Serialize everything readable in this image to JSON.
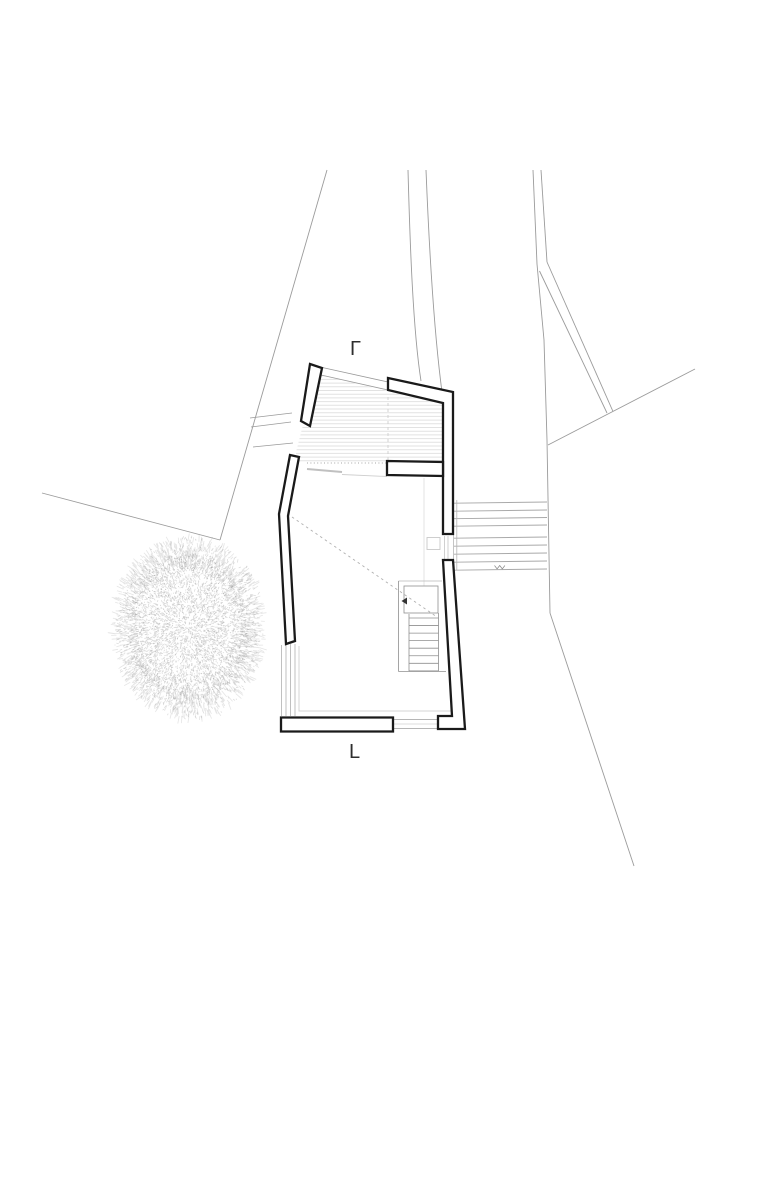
{
  "plan": {
    "title": "site-floor-plan",
    "width": 780,
    "height": 1188,
    "colors": {
      "background": "#ffffff",
      "wall_stroke": "#1a1a1a",
      "wall_fill": "#ffffff",
      "site_line": "#9b9b9b",
      "thin_line": "#8f8f8f",
      "light_line": "#bdbdbd",
      "faint_line": "#e0e0e0",
      "hatch_line": "#e2e2e2",
      "dash_line": "#b0b0b0",
      "tree_stipple": "#7d7d7d",
      "label": "#2e2e2e"
    },
    "labels": [
      {
        "text": "Γ",
        "x": 350,
        "y": 339,
        "size": 20
      },
      {
        "text": "L",
        "x": 349,
        "y": 742,
        "size": 20
      }
    ],
    "walls": [
      [
        [
          310,
          364
        ],
        [
          322,
          368
        ],
        [
          310,
          426
        ],
        [
          301,
          421
        ]
      ],
      [
        [
          388,
          378
        ],
        [
          453,
          392
        ],
        [
          453,
          534
        ],
        [
          443,
          534
        ],
        [
          443,
          403
        ],
        [
          388,
          390
        ]
      ],
      [
        [
          387,
          461
        ],
        [
          443,
          462
        ],
        [
          443,
          476
        ],
        [
          387,
          475
        ]
      ],
      [
        [
          443,
          560
        ],
        [
          453,
          560
        ],
        [
          465,
          729
        ],
        [
          438,
          729
        ],
        [
          438,
          716
        ],
        [
          452,
          716
        ]
      ],
      [
        [
          281,
          717.5
        ],
        [
          393,
          717.5
        ],
        [
          393,
          731.5
        ],
        [
          281,
          731.5
        ]
      ],
      [
        [
          290,
          455
        ],
        [
          299,
          457
        ],
        [
          288,
          516
        ],
        [
          295,
          641
        ],
        [
          286,
          644
        ],
        [
          279,
          514
        ]
      ]
    ],
    "wall_stroke_width": 2.3,
    "site_lines": [
      [
        [
          327,
          170
        ],
        [
          220,
          540
        ]
      ],
      [
        [
          220,
          540
        ],
        [
          42,
          493
        ]
      ],
      [
        [
          533,
          170
        ],
        [
          537,
          264
        ]
      ],
      [
        [
          541,
          170
        ],
        [
          547,
          262
        ]
      ],
      [
        [
          537,
          264
        ],
        [
          544,
          340
        ],
        [
          547,
          440
        ],
        [
          550,
          613
        ]
      ],
      [
        [
          539.5,
          271
        ],
        [
          607,
          413
        ]
      ],
      [
        [
          547,
          262
        ],
        [
          613,
          411.5
        ]
      ],
      [
        [
          695,
          369
        ],
        [
          548,
          445
        ]
      ],
      [
        [
          550,
          613
        ],
        [
          634,
          866
        ]
      ]
    ],
    "site_curves": [
      "M408,170 C410,245 413,330 421,381",
      "M426,170 C429,245 434,332 442,392"
    ],
    "thin_lines": [
      {
        "pts": [
          [
            320,
            367
          ],
          [
            388,
            382
          ]
        ]
      },
      {
        "pts": [
          [
            312,
            373
          ],
          [
            388,
            390
          ]
        ]
      },
      {
        "pts": [
          [
            250,
            418
          ],
          [
            292,
            413
          ]
        ]
      },
      {
        "pts": [
          [
            251,
            427
          ],
          [
            291,
            422
          ]
        ]
      },
      {
        "pts": [
          [
            253,
            447
          ],
          [
            293,
            443
          ]
        ]
      }
    ],
    "light_lines": [
      {
        "pts": [
          [
            281.5,
            645
          ],
          [
            281.5,
            716
          ]
        ],
        "c": "#b9b9b9",
        "w": 0.9
      },
      {
        "pts": [
          [
            286,
            645
          ],
          [
            286,
            716
          ]
        ],
        "c": "#b9b9b9",
        "w": 0.9
      },
      {
        "pts": [
          [
            290.5,
            644
          ],
          [
            290.5,
            716
          ]
        ],
        "c": "#b9b9b9",
        "w": 0.9
      },
      {
        "pts": [
          [
            295,
            644
          ],
          [
            295,
            716
          ]
        ],
        "c": "#b9b9b9",
        "w": 0.9
      },
      {
        "pts": [
          [
            299,
            646
          ],
          [
            299,
            711
          ],
          [
            452,
            711
          ]
        ],
        "c": "#d4d4d4",
        "w": 1
      },
      {
        "pts": [
          [
            394,
            719.5
          ],
          [
            437,
            719.5
          ]
        ],
        "c": "#9e9e9e",
        "w": 0.8
      },
      {
        "pts": [
          [
            394,
            724
          ],
          [
            437,
            724
          ]
        ],
        "c": "#dcdcdc",
        "w": 0.9
      },
      {
        "pts": [
          [
            394,
            728.5
          ],
          [
            437,
            728.5
          ]
        ],
        "c": "#9e9e9e",
        "w": 0.8
      },
      {
        "pts": [
          [
            307,
            469
          ],
          [
            342,
            472
          ]
        ],
        "c": "#c0c0c0",
        "w": 2
      },
      {
        "pts": [
          [
            342,
            474.5
          ],
          [
            387,
            476.5
          ]
        ],
        "c": "#cfcfcf",
        "w": 0.9
      },
      {
        "pts": [
          [
            424,
            478
          ],
          [
            424,
            586
          ]
        ],
        "c": "#e0e0e0",
        "w": 0.9
      },
      {
        "pts": [
          [
            444.5,
            536
          ],
          [
            444.5,
            562
          ]
        ],
        "c": "#c4c4c4",
        "w": 0.8
      },
      {
        "pts": [
          [
            448,
            536
          ],
          [
            448,
            562
          ]
        ],
        "c": "#c4c4c4",
        "w": 0.8
      }
    ],
    "door_square": {
      "x": 427,
      "y": 537.5,
      "w": 13,
      "h": 12,
      "c": "#c9c9c9"
    },
    "dashed_lines": [
      {
        "pts": [
          [
            292,
            517
          ],
          [
            437,
            617
          ]
        ],
        "dash": "2.5,3.2",
        "c": "#b0b0b0",
        "w": 0.9
      },
      {
        "pts": [
          [
            388,
            397
          ],
          [
            388,
            462
          ]
        ],
        "dash": "3,3",
        "c": "#cfcfcf",
        "w": 0.9
      },
      {
        "pts": [
          [
            307,
            463
          ],
          [
            387,
            463
          ]
        ],
        "dash": "1,2.4",
        "c": "#a5a5a5",
        "w": 1
      }
    ],
    "hatch": {
      "clip": [
        [
          312,
          373
        ],
        [
          388,
          391
        ],
        [
          443,
          404
        ],
        [
          443,
          461
        ],
        [
          387,
          461
        ],
        [
          387,
          464
        ],
        [
          296,
          464
        ],
        [
          296,
          452
        ],
        [
          303,
          425
        ],
        [
          310,
          421
        ]
      ],
      "y_start": 372,
      "y_end": 464,
      "spacing": 3.7,
      "x1": 290,
      "x2": 450
    },
    "exterior_stairs": {
      "tread_ys": [
        502,
        510,
        517.5,
        525,
        537,
        545,
        553,
        561,
        569
      ],
      "x1": 454,
      "x2": 547,
      "left_drop": 1.2,
      "edge_xs": [
        453.6,
        456.8
      ],
      "edge_y1": 500,
      "edge_y2": 570.5,
      "line_color": "#a9a9a9",
      "edge_color": "#b5b5b5"
    },
    "interior_stairs": {
      "well_top": [
        [
          398.5,
          581
        ],
        [
          442,
          581
        ]
      ],
      "well_left": [
        [
          398.5,
          581
        ],
        [
          398.5,
          671.5
        ]
      ],
      "well_bottom": [
        [
          398.5,
          671.5
        ],
        [
          446,
          671.5
        ]
      ],
      "landing": {
        "x": 404,
        "y": 586,
        "w": 34,
        "h": 27
      },
      "tread_edge_left": [
        [
          409,
          614
        ],
        [
          409,
          671
        ]
      ],
      "tread_edge_right": [
        [
          438.5,
          613
        ],
        [
          438.5,
          671
        ]
      ],
      "treads": {
        "x1": 409,
        "x2": 438.5,
        "y0": 618,
        "dy": 7.55,
        "n": 8
      },
      "arrow": [
        [
          401.5,
          601
        ],
        [
          407,
          597.5
        ],
        [
          407,
          604.5
        ]
      ],
      "color": "#8f8f8f"
    },
    "level_mark": {
      "d": "M494.5,565.5 l2.6,3.4 l2.6,-3.4 l2.6,3.4 l2.6,-3.4",
      "c": "#8a8a8a"
    },
    "tree": {
      "cx": 188.5,
      "cy": 628,
      "r": 78,
      "sx": 0.86,
      "sy": 1.04,
      "seed": 99,
      "dense_count": 3200,
      "spike_count": 1100,
      "dot_count": 1500
    }
  }
}
